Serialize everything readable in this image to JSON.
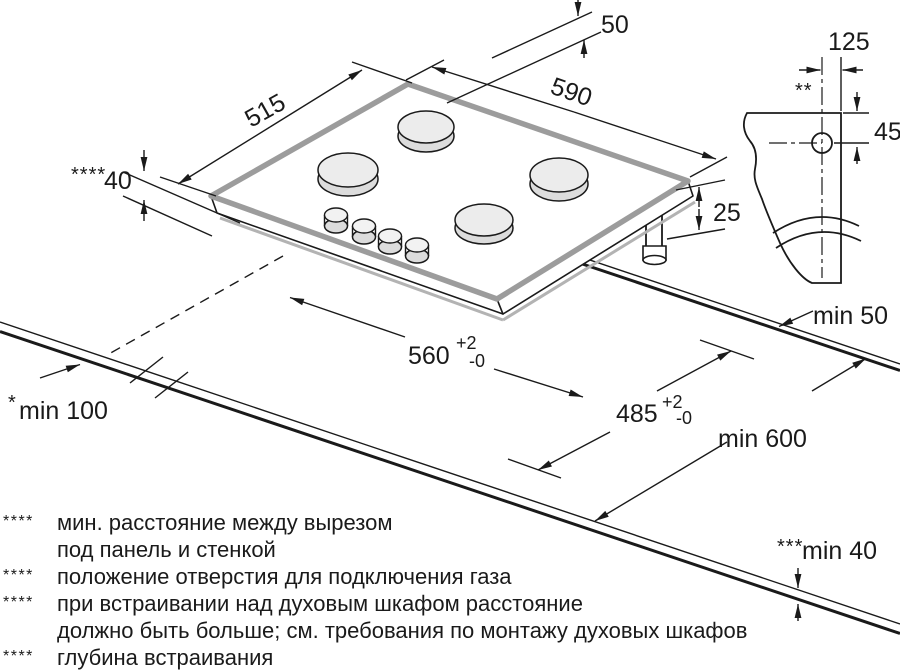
{
  "dims": {
    "burner_rear_offset": "50",
    "hob_depth": "515",
    "hob_width": "590",
    "mount_depth_marker": "****",
    "mount_depth_value": "40",
    "body_height": "25",
    "gas_hole_top_offset": "125",
    "gas_hole_marker": "**",
    "gas_hole_side_offset": "45",
    "rear_clearance": "min 50",
    "cutout_width": "560",
    "cutout_depth": "485",
    "tolerance_plus": "+2",
    "tolerance_minus": "-0",
    "worktop_min_depth": "min 600",
    "side_clearance_marker": "*",
    "side_clearance_value": "min 100",
    "front_clearance_marker": "***",
    "front_clearance_value": "min 40"
  },
  "footnotes": [
    {
      "marker": "****",
      "lines": [
        "мин. расстояние между вырезом",
        "под панель и стенкой"
      ]
    },
    {
      "marker": "****",
      "lines": [
        "положение отверстия для подключения газа"
      ]
    },
    {
      "marker": "****",
      "lines": [
        "при встраивании над духовым шкафом расстояние",
        "должно быть больше; см. требования по монтажу духовых шкафов"
      ]
    },
    {
      "marker": "****",
      "lines": [
        "глубина встраивания"
      ]
    }
  ],
  "colors": {
    "line": "#1a1a1a",
    "hob_edge_gray": "#9c9c9c",
    "shadow_gray": "#b3b3b3",
    "burner_fill": "#ececec",
    "background": "#ffffff"
  }
}
